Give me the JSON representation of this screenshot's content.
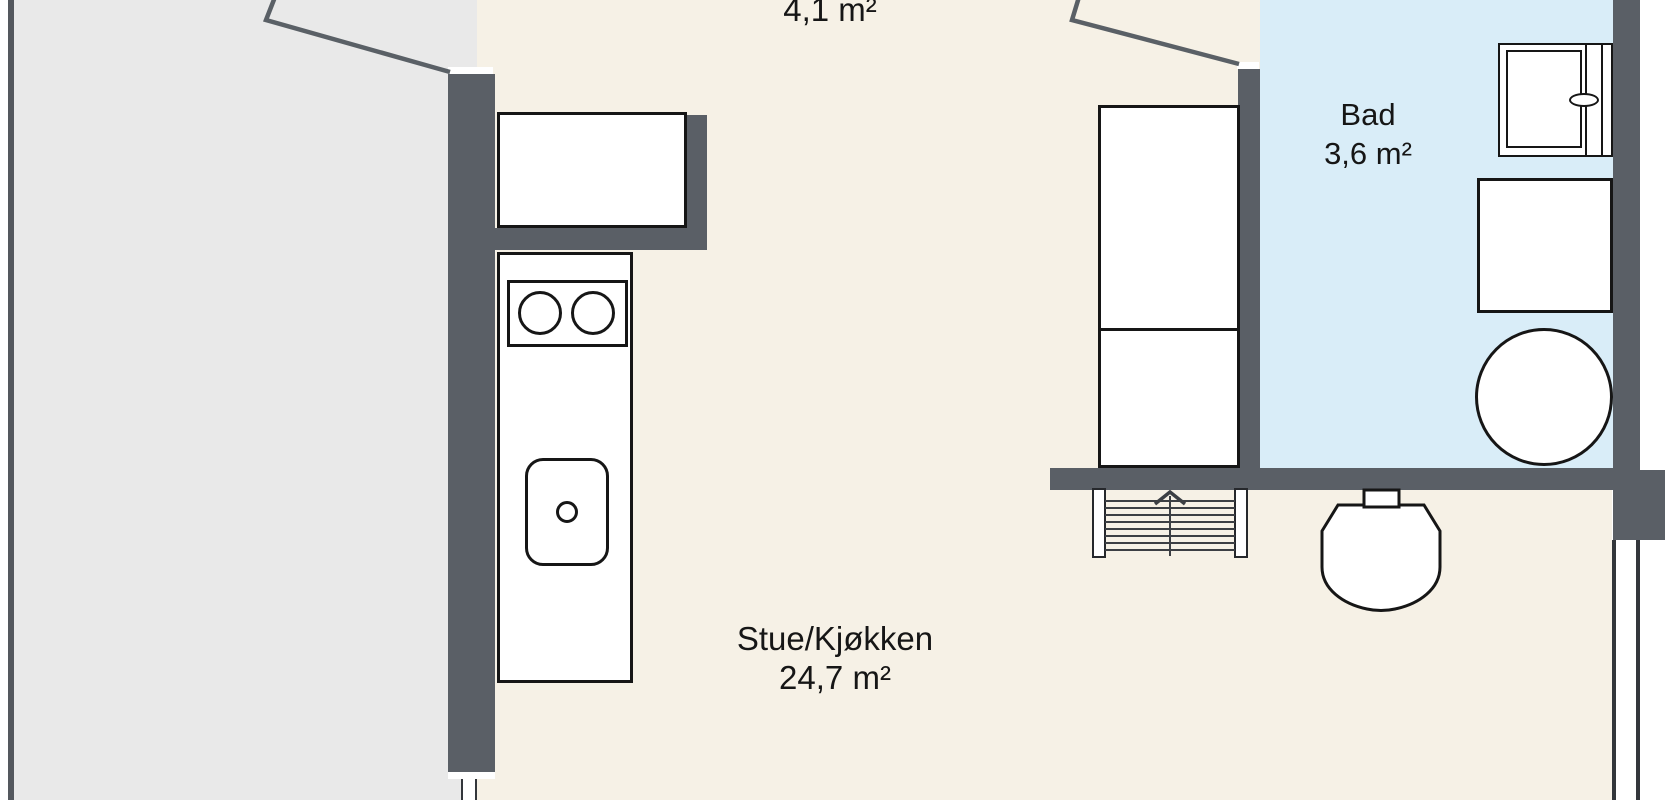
{
  "floorplan": {
    "rooms": {
      "hall": {
        "area_label": "4,1 m²"
      },
      "bath": {
        "name": "Bad",
        "area_label": "3,6 m²"
      },
      "living": {
        "name": "Stue/Kjøkken",
        "area_label": "24,7 m²"
      }
    },
    "colors": {
      "background": "#ffffff",
      "wall": "#5a5f66",
      "outline": "#161616",
      "living_floor": "#f6f1e6",
      "bath_floor": "#d9edf8",
      "terrace_floor": "#e9e9e9",
      "terrace_border": "#54585e",
      "door_line": "#5a6066",
      "stair_line": "#3c3f44"
    },
    "fixtures": [
      "refrigerator",
      "kitchen-counter",
      "cooktop-two-burners",
      "kitchen-sink",
      "wardrobe",
      "bathroom-vanity",
      "shower-cabinet",
      "washing-machine",
      "toilet",
      "staircase-up",
      "entry-door",
      "bath-door",
      "window",
      "door-frame"
    ]
  }
}
